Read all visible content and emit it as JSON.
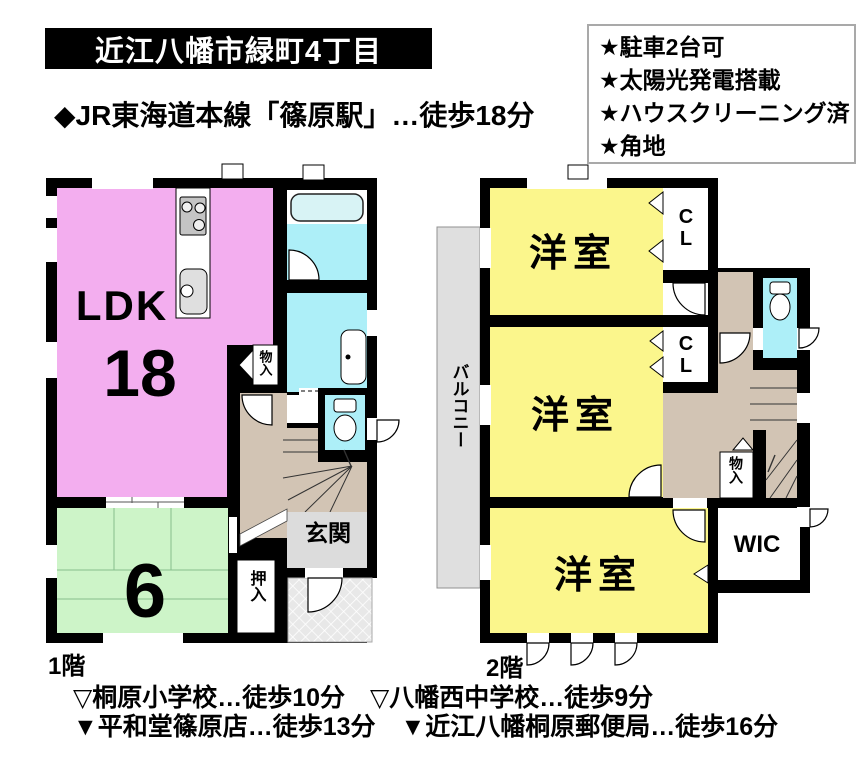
{
  "header": {
    "address_title": "近江八幡市緑町4丁目",
    "station_access": "◆JR東海道本線「篠原駅」…徒歩18分",
    "features": [
      "★駐車2台可",
      "★太陽光発電搭載",
      "★ハウスクリーニング済",
      "★角地"
    ]
  },
  "floor1": {
    "label": "1階",
    "ldk": "LDK",
    "ldk_size": "18",
    "tatami_size": "6",
    "genkan": "玄関",
    "oshiire": "押入",
    "storage": "物入"
  },
  "floor2": {
    "label": "2階",
    "room1": "洋室",
    "room2": "洋室",
    "room3": "洋室",
    "closet1": "CL",
    "closet2": "CL",
    "wic": "WIC",
    "storage": "物入",
    "balcony": "バルコニー"
  },
  "footer": {
    "line1": "▽桐原小学校…徒歩10分　▽八幡西中学校…徒歩9分",
    "line2": "▼平和堂篠原店…徒歩13分　▼近江八幡桐原郵便局…徒歩16分"
  },
  "colors": {
    "wall": "#000000",
    "ldk_pink": "#F3AEEF",
    "western_yellow": "#FBF68C",
    "tatami_green": "#CDF4C8",
    "water_cyan": "#ADEFF8",
    "bathtub": "#D8F3F5",
    "hall_tan": "#D2C4B4",
    "genkan_gray": "#DCDCDC",
    "balcony_gray": "#DFDFDF"
  }
}
